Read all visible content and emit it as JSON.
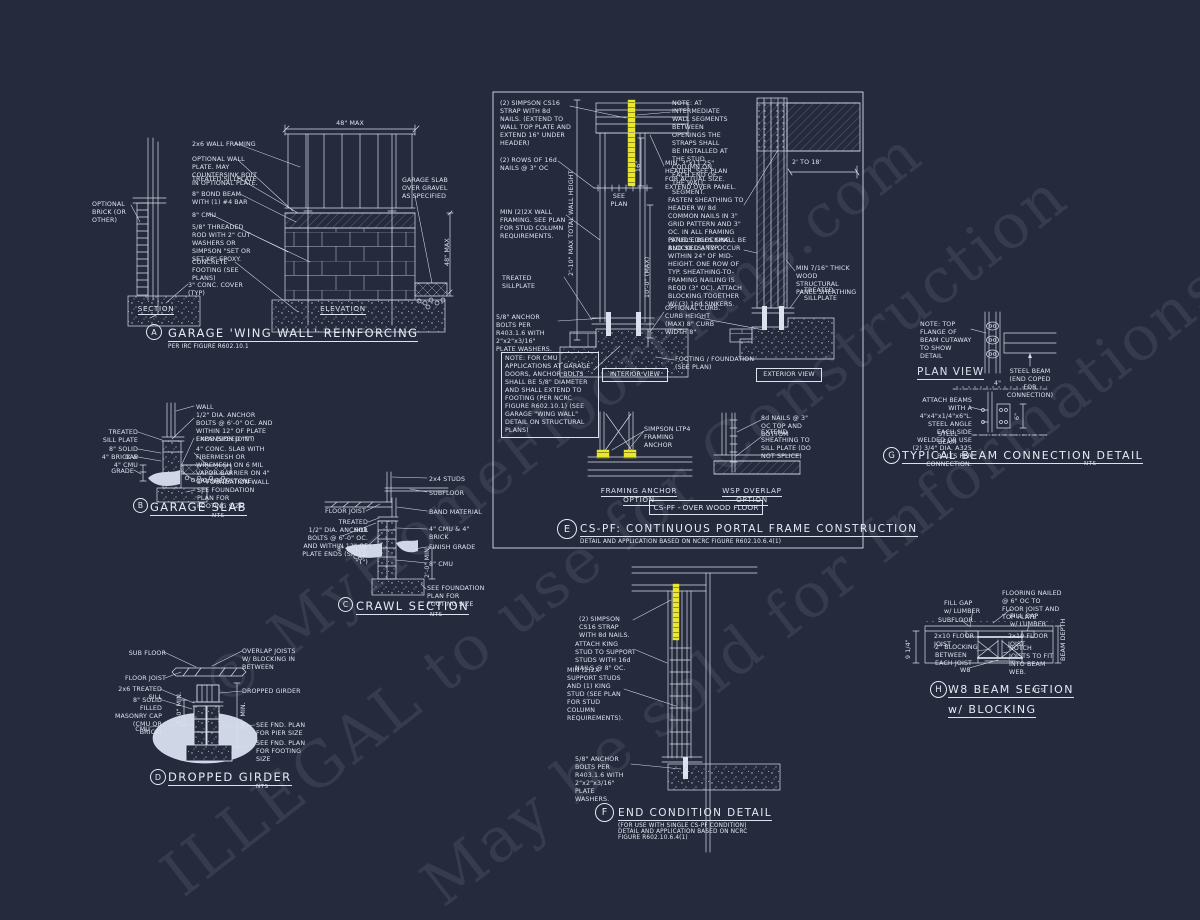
{
  "colors": {
    "background": "#252a3c",
    "ink": "#dde2ee",
    "highlight": "#e9e72f"
  },
  "watermark": {
    "line1": "© MyHomeFloorPlans.com",
    "line2": "ILLEGAL to use for Construction",
    "line3": "May be sold for Informations"
  },
  "a": {
    "letter": "A",
    "title": "GARAGE 'WING WALL' REINFORCING",
    "sub": "PER IRC FIGURE R602.10.1",
    "section_label": "SECTION",
    "elevation_label": "ELEVATION",
    "dim_top": "48\" MAX",
    "dim_right": "48\" MAX",
    "optional_brick": "OPTIONAL BRICK (OR OTHER)",
    "garage_slab": "GARAGE SLAB OVER GRAVEL AS SPECIFIED",
    "labels": [
      "2x6 WALL FRAMING",
      "OPTIONAL WALL PLATE. MAY COUNTERSINK BOLT IN OPTIONAL PLATE.",
      "TREATED SILLPLATE",
      "8\" BOND BEAM WITH (1) #4 BAR",
      "8\" CMU",
      "5/8\" THREADED ROD WITH 2\" CUT WASHERS OR SIMPSON \"SET OR SET-XP\" EPOXY.",
      "CONCRETE FOOTING (SEE PLANS)",
      "3\" CONC. COVER (TYP)"
    ]
  },
  "b": {
    "letter": "B",
    "title": "GARAGE SLAB",
    "nts": "NTS",
    "labels_left": [
      "TREATED SILL PLATE",
      "8\" SOLID CAP",
      "4\" BRICK & 4\" CMU",
      "GRADE"
    ],
    "labels_right": [
      "WALL",
      "1/2\" DIA. ANCHOR BOLTS @ 6'-0\" OC. AND WITHIN 12\" OF PLATE ENDS (SPEED \"T\")",
      "EXPANSION JOINT",
      "4\" CONC. SLAB WITH FIBERMESH OR WIREMESH ON 6 MIL VAPOR BARRIER ON 4\" CRUSHED STONE",
      "8\" FOUNDATION WALL",
      "SEE FOUNDATION PLAN FOR FOOTING SIZE"
    ]
  },
  "c": {
    "letter": "C",
    "title": "CRAWL SECTION",
    "nts": "NTS",
    "dim": "2'-0\" MIN.",
    "labels_left": [
      "FLOOR JOIST",
      "TREATED SILL",
      "1/2\" DIA. ANCHOR BOLTS @ 6'-0\" OC. AND WITHIN 12\" OF PLATE ENDS (SPEED \"T\")",
      "8\" SOLID CAP"
    ],
    "labels_right": [
      "2x4 STUDS",
      "SUBFLOOR",
      "BAND MATERIAL",
      "4\" CMU & 4\" BRICK",
      "FINISH GRADE",
      "8\" CMU",
      "SEE FOUNDATION PLAN FOR FOOTING SIZE"
    ]
  },
  "d": {
    "letter": "D",
    "title": "DROPPED GIRDER",
    "nts": "NTS",
    "dim_left": "1'-0\" MIN.",
    "dim_right": "24\" MIN.",
    "labels_left": [
      "SUB FLOOR",
      "FLOOR JOIST",
      "2x6 TREATED SILL",
      "8\" SOLID FILLED MASONRY CAP (CMU OR BRICK)",
      "CMU"
    ],
    "labels_right": [
      "OVERLAP JOISTS W/ BLOCKING IN BETWEEN",
      "DROPPED GIRDER",
      "SEE FND. PLAN FOR PIER SIZE",
      "SEE FND. PLAN FOR FOOTING SIZE"
    ]
  },
  "e": {
    "letter": "E",
    "title": "CS-PF: CONTINUOUS PORTAL FRAME CONSTRUCTION",
    "sub": "DETAIL AND APPLICATION BASED ON NCRC FIGURE R602.10.6.4(1)",
    "interior_view": "INTERIOR VIEW",
    "exterior_view": "EXTERIOR VIEW",
    "floor_box": "CS-PF - OVER WOOD FLOOR",
    "framing_option": "FRAMING ANCHOR OPTION",
    "wsp_option": "WSP OVERLAP OPTION",
    "see_plan": "SEE\nPLAN",
    "dim_wall": "2'-10\" MAX TOTAL WALL HEIGHT",
    "dim_height": "10'-0\" (MAX)",
    "dim_16": "16\"",
    "dim_span": "2' TO 18'",
    "labels_left": [
      "(2) SIMPSON CS16 STRAP WITH 8d NAILS. (EXTEND TO WALL TOP PLATE AND EXTEND 16\" UNDER HEADER)",
      "(2) ROWS OF 16d NAILS @ 3\" OC",
      "MIN (2)2X WALL FRAMING. SEE PLAN FOR STUD COLUMN REQUIREMENTS.",
      "TREATED SILLPLATE",
      "5/8\" ANCHOR BOLTS PER R403.1.6 WITH 2\"x2\"x3/16\" PLATE WASHERS."
    ],
    "note_box": "NO​TE: FOR CMU APPLICATIONS AT GARAGE DOORS, ANCHOR BOLTS SHALL BE 5/8\" DIAMETER AND SHALL EXTEND TO FOOTING (PER NCRC FIGURE R602.10.1) (SEE GARAGE \"WING WALL\" DETAIL ON STRUCTURAL PLANS)",
    "labels_right": [
      "NOTE: AT INTERMEDIATE WALL SEGMENTS BETWEEN OPENINGS THE STRAPS SHALL BE INSTALLED AT THE STUD COLUMN ON EACH END OF THE WALL SEGMENT.",
      "MIN. 3\"x11.25\" HEADER. SEE PLAN FOR ACTUAL SIZE. EXTEND OVER PANEL.",
      "FASTEN SHEATHING TO HEADER W/ 8d COMMON NAILS IN 3\" GRID PATTERN AND 3\" OC. IN ALL FRAMING (STUDS, BLOCKING, AND SILLS) TYP.",
      "PANEL EDGES SHALL BE BLOCKED AND OCCUR WITHIN 24\" OF MID-HEIGHT. ONE ROW OF TYP. SHEATHING-TO-FRAMING NAILING IS REQD (3\" OC). ATTACH BLOCKING TOGETHER W/ (3) 16d SINKERS.",
      "MIN 7/16\" THICK WOOD STRUCTURAL PANEL SHEATHING",
      "TREATED SILLPLATE",
      "OPTIONAL CURB. CURB HEIGHT (MAX) 8\" CURB WIDTH 8\"",
      "FOOTING / FOUNDATION (SEE PLAN)"
    ],
    "labels_bottom": [
      "SIMPSON LTP4 FRAMING ANCHOR",
      "8d NAILS @ 3\" OC TOP AND BOTTOM",
      "EXTEND SHEATHING TO SILL PLATE (DO NOT SPLICE)"
    ]
  },
  "f": {
    "letter": "F",
    "title": "END CONDITION DETAIL",
    "sub": "(FOR USE WITH SINGLE CS-PF CONDITION)\nDETAIL AND APPLICATION BASED ON NCRC\nFIGURE R602.10.6.4(1)",
    "labels": [
      "(2) SIMPSON CS16 STRAP WITH 8d NAILS.",
      "ATTACH KING STUD TO SUPPORT STUDS WITH 16d NAILS @ 8\" OC.",
      "MIN (2)2X SUPPORT STUDS AND (1) KING STUD (SEE PLAN FOR STUD COLUMN REQUIREMENTS).",
      "5/8\" ANCHOR BOLTS PER R403.1.6 WITH 2\"x2\"x3/16\" PLATE WASHERS."
    ]
  },
  "g": {
    "letter": "G",
    "title": "TYPICAL BEAM CONNECTION DETAIL",
    "nts": "NTS",
    "plan_view": "PLAN VIEW",
    "dim_4": "4\"",
    "dim_6": "6\"",
    "labels": [
      "NOTE: TOP FLANGE OF BEAM CUTAWAY TO SHOW DETAIL",
      "STEEL BEAM (END COPED FOR CONNECTION)",
      "ATTACH BEAMS WITH A 4\"x4\"x1/4\"x6\"L. STEEL ANGLE EACH SIDE WELDED OR USE (2) 3/4\" DIA. A325 BOLTS PER CONNECTION.",
      "STEEL BEAM"
    ]
  },
  "h": {
    "letter": "H",
    "title": "W8 BEAM SECTION",
    "title2": "w/ BLOCKING",
    "nts": "NTS",
    "dim_left": "9 1/4\"",
    "dim_right": "BEAM DEPTH",
    "labels": [
      "FILL GAP w/ LUMBER",
      "SUBFLOOR",
      "FLOORING NAILED @ 6\" OC TO FLOOR JOIST AND TOP PLATE",
      "FILL GAP w/ LUMBER",
      "2x10 FLOOR JOIST",
      "2x10 FLOOR JOIST",
      "2\" BLOCKING BETWEEN EACH JOIST",
      "NOTCH JOISTS TO FIT INTO BEAM WEB.",
      "W8"
    ]
  }
}
